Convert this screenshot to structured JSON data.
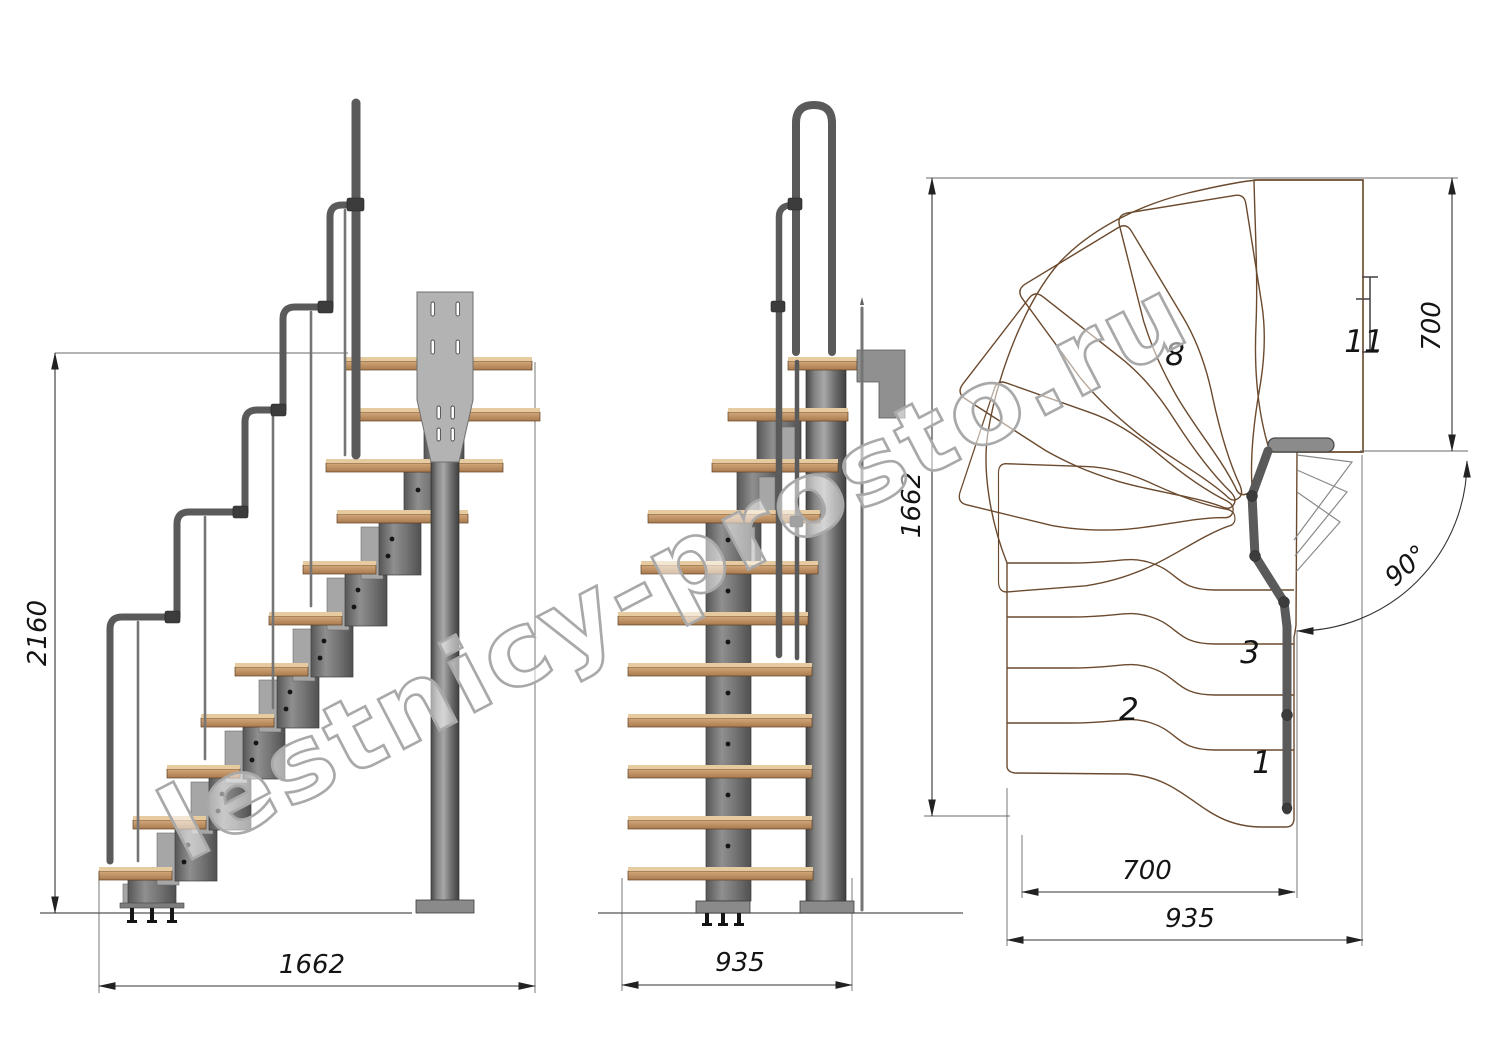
{
  "drawing": {
    "watermark": "lestnicy-prosto.ru",
    "side_view": {
      "height_dim": "2160",
      "length_dim": "1662"
    },
    "front_view": {
      "width_dim": "935"
    },
    "plan_view": {
      "height_dim": "1662",
      "landing_dim": "700",
      "angle_dim": "90°",
      "flight_width_dim": "700",
      "total_width_dim": "935",
      "tread_numbers": [
        "1",
        "2",
        "3",
        "8",
        "11"
      ]
    }
  }
}
